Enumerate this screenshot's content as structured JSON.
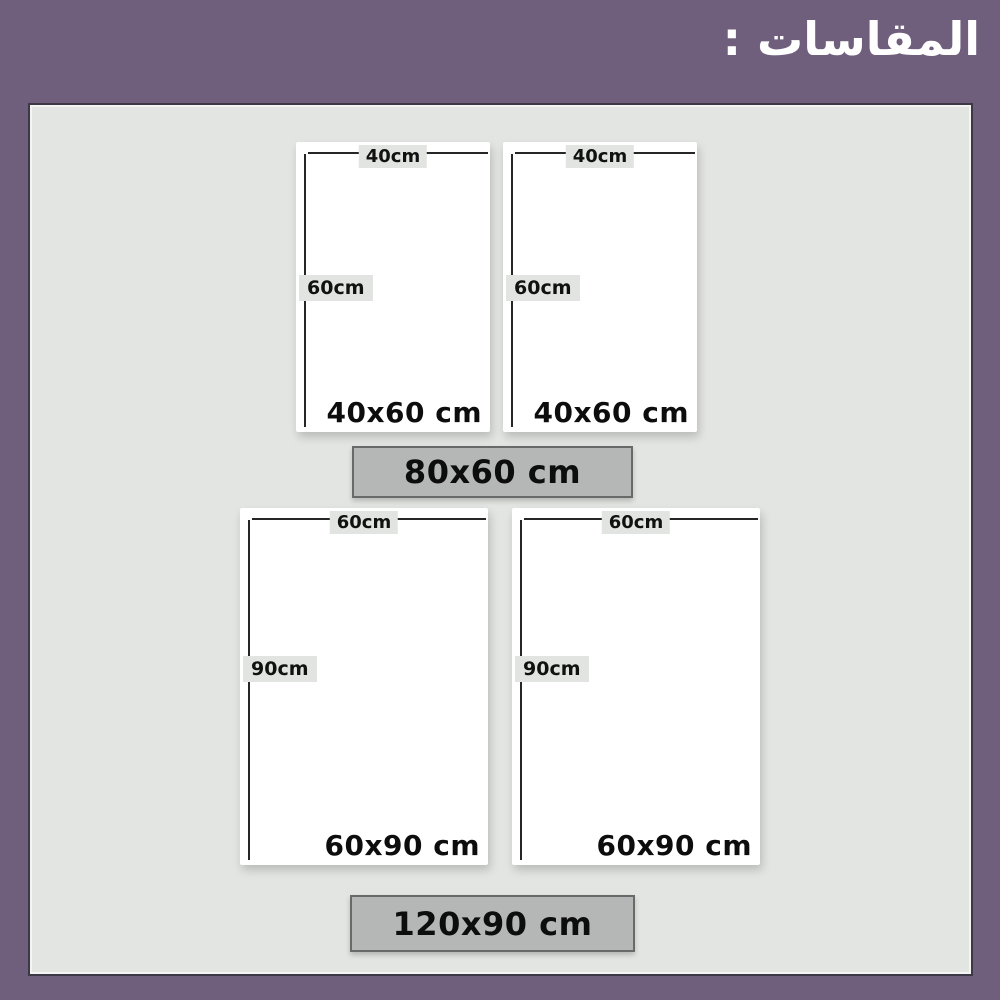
{
  "header": {
    "title": "المقاسات :"
  },
  "panels": [
    {
      "name": "top-left",
      "width_label": "40cm",
      "height_label": "60cm",
      "size_label": "40x60 cm"
    },
    {
      "name": "top-right",
      "width_label": "40cm",
      "height_label": "60cm",
      "size_label": "40x60 cm"
    },
    {
      "name": "bottom-left",
      "width_label": "60cm",
      "height_label": "90cm",
      "size_label": "60x90 cm"
    },
    {
      "name": "bottom-right",
      "width_label": "60cm",
      "height_label": "90cm",
      "size_label": "60x90 cm"
    }
  ],
  "banners": [
    {
      "label": "80x60 cm"
    },
    {
      "label": "120x90 cm"
    }
  ],
  "colors": {
    "header_bg": "#6f5f7d",
    "title_text": "#ffffff",
    "board_bg": "#e3e5e2",
    "board_border": "#3c3845",
    "panel_bg": "#ffffff",
    "dimension_line": "#262626",
    "dimension_label_bg": "#e2e4e1",
    "banner_bg": "#b4b7b5",
    "banner_border": "#676a68",
    "text": "#0d0d0d"
  }
}
